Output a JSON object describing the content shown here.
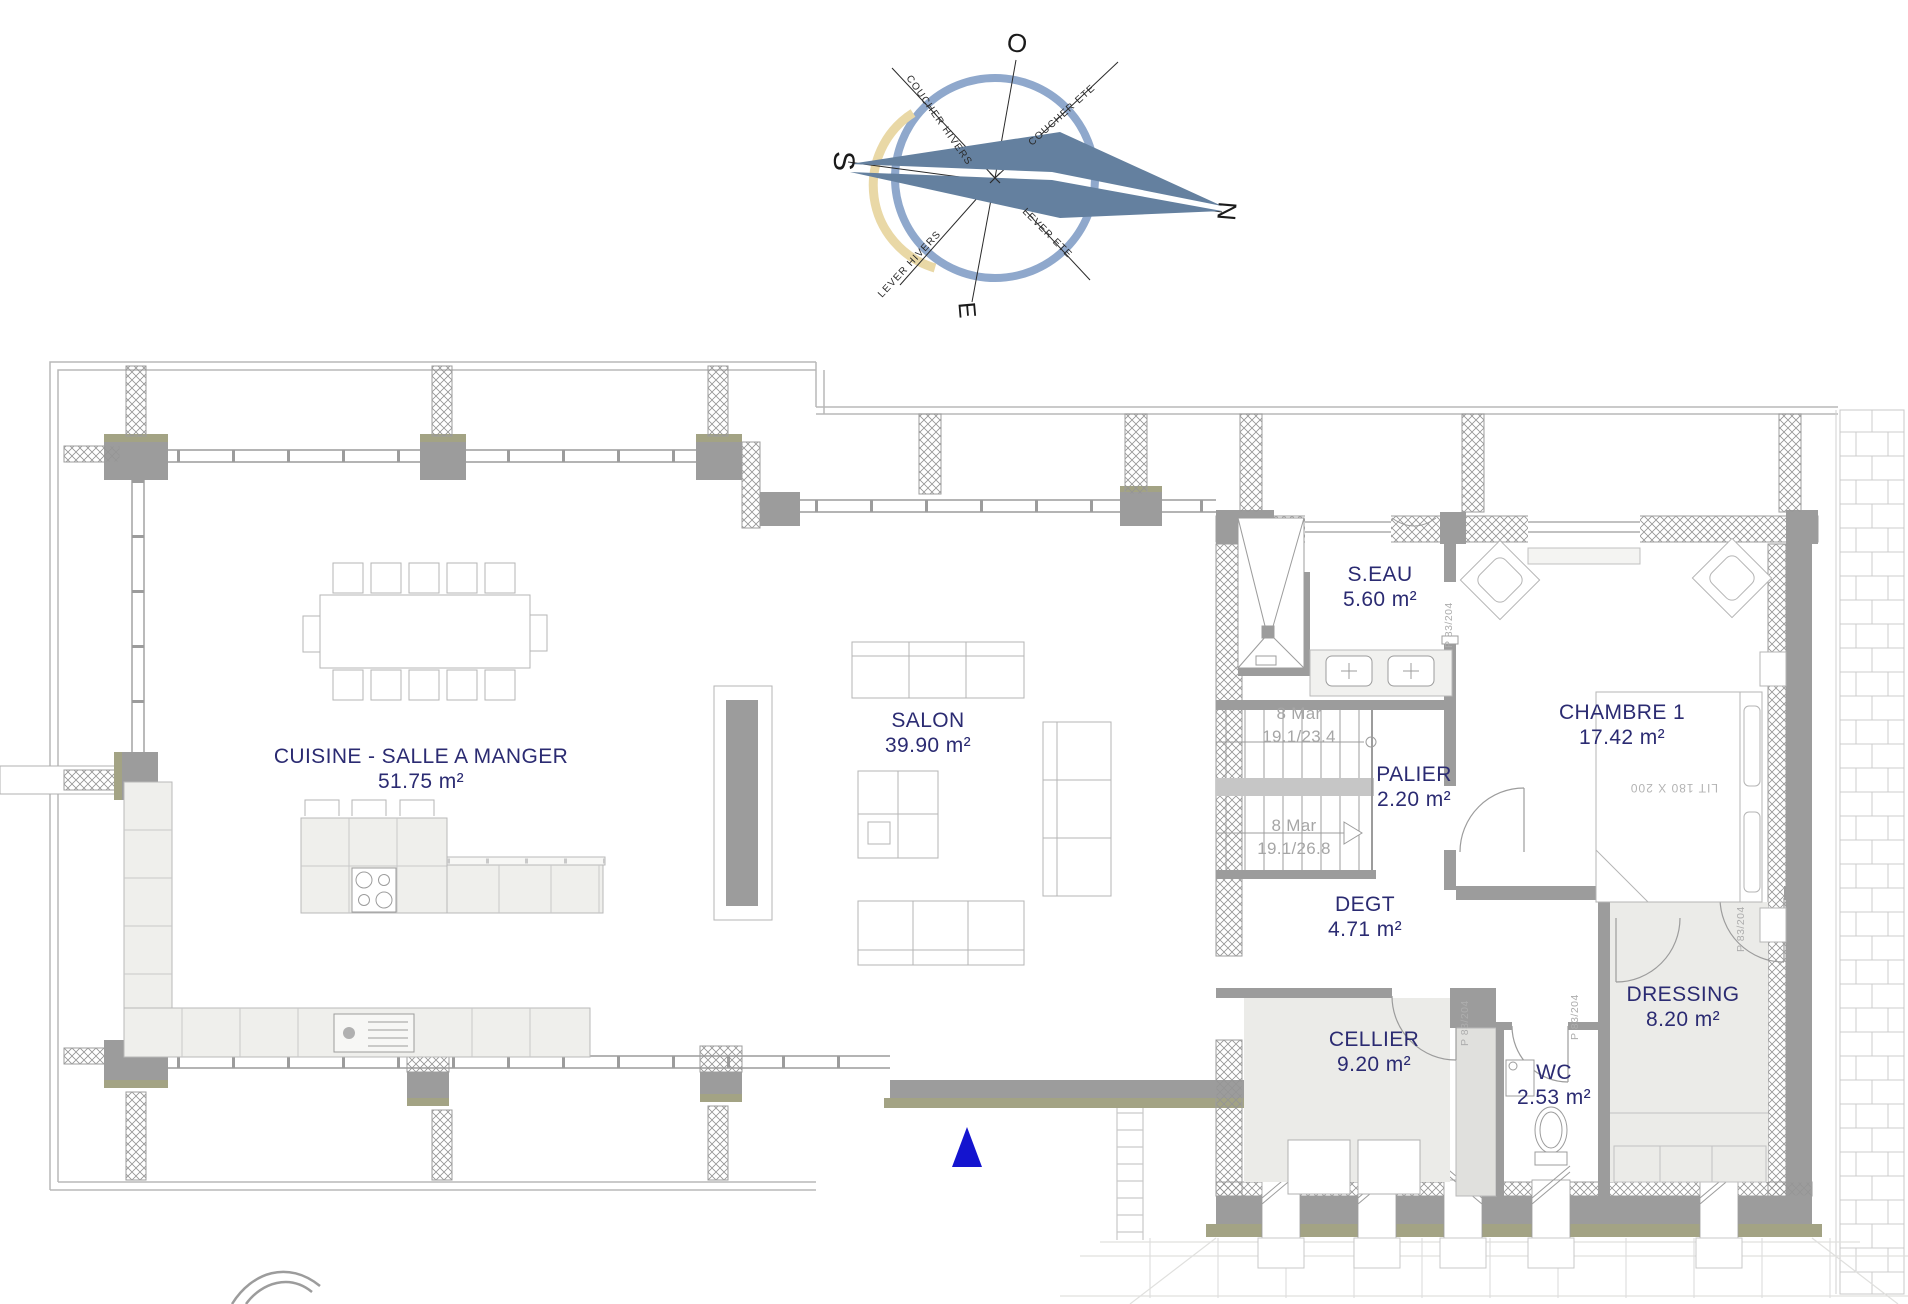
{
  "compass": {
    "o": "O",
    "s": "S",
    "n": "N",
    "e": "E",
    "ray_labels": [
      "COUCHER HIVERS",
      "COUCHER ETE",
      "LEVER HIVERS",
      "LEVER ETE"
    ]
  },
  "rooms": {
    "cuisine": {
      "name": "CUISINE - SALLE A MANGER",
      "area": "51.75 m²"
    },
    "salon": {
      "name": "SALON",
      "area": "39.90 m²"
    },
    "seau": {
      "name": "S.EAU",
      "area": "5.60 m²"
    },
    "chambre": {
      "name": "CHAMBRE 1",
      "area": "17.42 m²"
    },
    "palier": {
      "name": "PALIER",
      "area": "2.20 m²"
    },
    "degt": {
      "name": "DEGT",
      "area": "4.71 m²"
    },
    "cellier": {
      "name": "CELLIER",
      "area": "9.20 m²"
    },
    "wc": {
      "name": "WC",
      "area": "2.53 m²"
    },
    "dressing": {
      "name": "DRESSING",
      "area": "8.20 m²"
    }
  },
  "stairs": {
    "upper": {
      "steps": "8 Mar",
      "dims": "19.1/23.4"
    },
    "lower": {
      "steps": "8 Mar",
      "dims": "19.1/26.8"
    }
  },
  "annotations": {
    "bed": "LIT 180 X 200",
    "door": "P 83/204"
  },
  "colors": {
    "label_navy": "#2b2b72",
    "wall_gray": "#9c9c9c",
    "olive": "#a3a384",
    "compass_ring_blue": "#8fa8cc",
    "compass_arc_yellow": "#e9d8a6",
    "needle_blue": "#64809f",
    "entrance_blue": "#1414cf",
    "stair_text_gray": "#a6a6a6"
  }
}
